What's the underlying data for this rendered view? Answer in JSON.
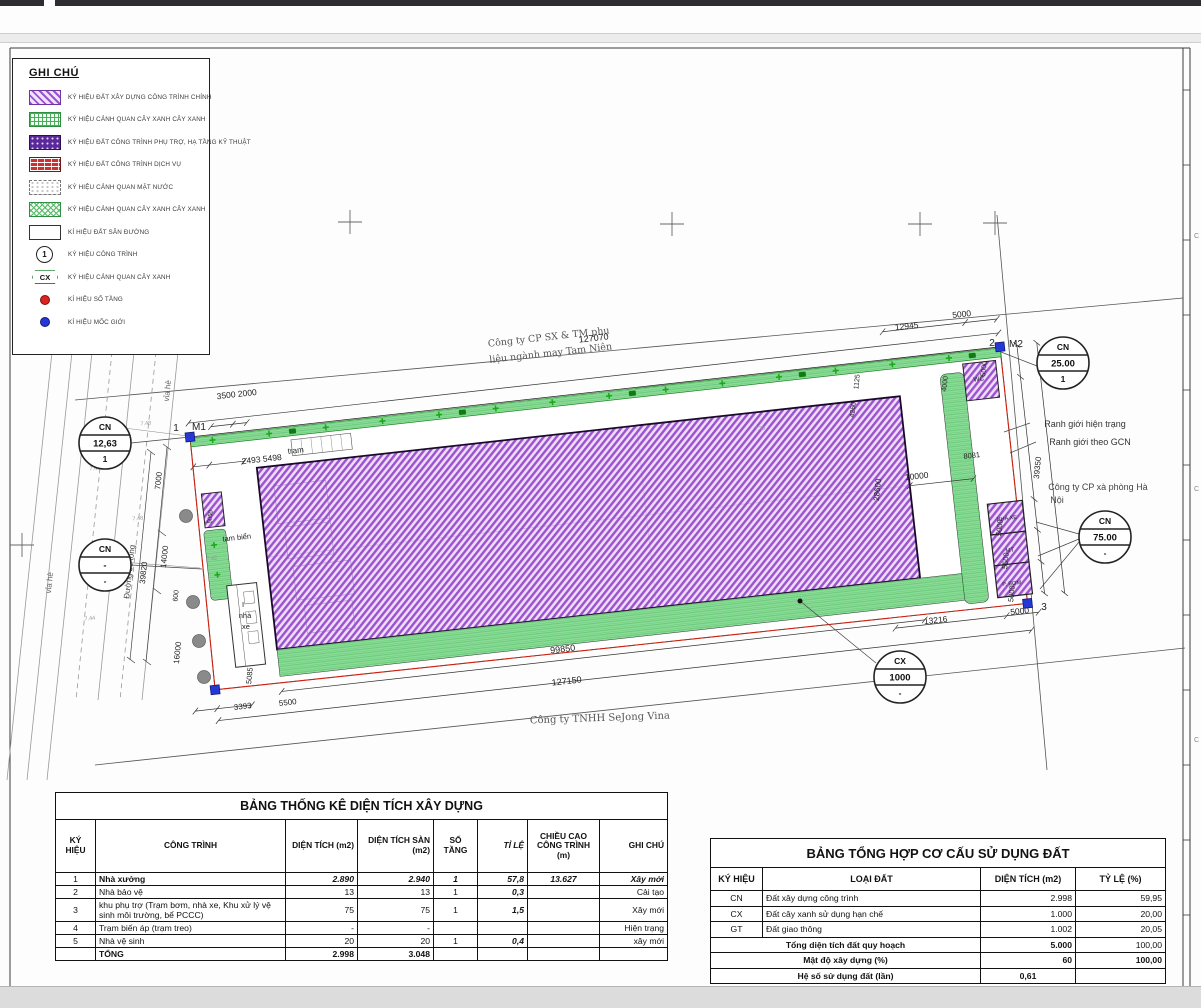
{
  "colors": {
    "purple": "#9b52cf",
    "green": "#79d489",
    "red": "#cc2211",
    "blue": "#2538d6",
    "line": "#333333"
  },
  "legend": {
    "title": "GHI CHÚ",
    "items": [
      {
        "swatch": "hatch-purple",
        "label": "KÝ HIỆU ĐẤT XÂY DỰNG CÔNG TRÌNH CHÍNH"
      },
      {
        "swatch": "grid-green",
        "label": "KÝ HIỆU CẢNH QUAN CÂY XANH CÂY XANH"
      },
      {
        "swatch": "dots-purple",
        "label": "KÝ HIỆU ĐẤT CÔNG TRÌNH PHỤ TRỢ, HẠ TẦNG KỸ THUẬT"
      },
      {
        "swatch": "brick-red",
        "label": "KÝ HIỆU ĐẤT CÔNG TRÌNH DỊCH VỤ"
      },
      {
        "swatch": "dots-white",
        "label": "KÝ HIỆU CẢNH QUAN MẶT NƯỚC"
      },
      {
        "swatch": "cross-green",
        "label": "KÝ HIỆU CẢNH QUAN CÂY XANH CÂY XANH"
      },
      {
        "swatch": "plain-white",
        "label": "KÍ HIỆU ĐẤT SÂN ĐƯỜNG"
      },
      {
        "swatch": "circle-1",
        "symbol": "1",
        "label": "KÝ HIỆU CÔNG TRÌNH"
      },
      {
        "swatch": "cx-badge",
        "symbol": "CX",
        "label": "KÝ HIỆU CẢNH QUAN CÂY XANH"
      },
      {
        "swatch": "dot-red",
        "label": "KÍ HIỆU SỐ TẦNG"
      },
      {
        "swatch": "dot-blue",
        "label": "KÍ HIỆU MỐC GIỚI"
      }
    ]
  },
  "plan": {
    "badges": [
      {
        "x": 105,
        "y": 443,
        "top": "CN",
        "mid": "12,63",
        "bot": "1"
      },
      {
        "x": 105,
        "y": 565,
        "top": "CN",
        "mid": "-",
        "bot": "-"
      },
      {
        "x": 1063,
        "y": 363,
        "top": "CN",
        "mid": "25.00",
        "bot": "1"
      },
      {
        "x": 1105,
        "y": 537,
        "top": "CN",
        "mid": "75.00",
        "bot": "-"
      },
      {
        "x": 900,
        "y": 677,
        "top": "CX",
        "mid": "1000",
        "bot": "-"
      }
    ],
    "texts": [
      {
        "t": "Công ty CP SX & TM phụ",
        "x": 549,
        "y": 340,
        "r": -6.3,
        "s": 9.5,
        "c": "#555",
        "f": 1
      },
      {
        "t": "liệu ngành may Tam Niên",
        "x": 551,
        "y": 356,
        "r": -6.3,
        "s": 9.5,
        "c": "#555",
        "f": 1
      },
      {
        "t": "127070",
        "x": 594,
        "y": 341,
        "r": -6.3,
        "s": 9
      },
      {
        "t": "12945",
        "x": 907,
        "y": 329,
        "r": -6.3,
        "s": 8.5
      },
      {
        "t": "5000",
        "x": 962,
        "y": 317,
        "r": -6.3,
        "s": 8.5
      },
      {
        "t": "1",
        "x": 176,
        "y": 431,
        "r": 0,
        "s": 10
      },
      {
        "t": "M1",
        "x": 199,
        "y": 430,
        "r": 0,
        "s": 10
      },
      {
        "t": "2",
        "x": 992,
        "y": 346,
        "r": 0,
        "s": 10
      },
      {
        "t": "M2",
        "x": 1016,
        "y": 347,
        "r": 0,
        "s": 10
      },
      {
        "t": "3",
        "x": 1044,
        "y": 610,
        "r": 0,
        "s": 10
      },
      {
        "t": "3500 2000",
        "x": 237,
        "y": 397,
        "r": -6.3,
        "s": 8.5
      },
      {
        "t": "2493   5498",
        "x": 262,
        "y": 462,
        "r": -6.3,
        "s": 8.5
      },
      {
        "t": "trạm",
        "x": 296,
        "y": 453,
        "r": -6.3,
        "s": 8
      },
      {
        "t": "tam biển",
        "x": 237,
        "y": 540,
        "r": -6.3,
        "s": 7.5
      },
      {
        "t": "1125",
        "x": 859,
        "y": 382,
        "r": -84,
        "s": 7
      },
      {
        "t": "4260",
        "x": 855,
        "y": 410,
        "r": -84,
        "s": 7
      },
      {
        "t": "4000",
        "x": 947,
        "y": 384,
        "r": -84,
        "s": 7
      },
      {
        "t": "5000",
        "x": 986,
        "y": 369,
        "r": -84,
        "s": 7
      },
      {
        "t": "8081",
        "x": 972,
        "y": 458,
        "r": -6.3,
        "s": 7.5
      },
      {
        "t": "10000",
        "x": 917,
        "y": 479,
        "r": -6.3,
        "s": 8.5
      },
      {
        "t": "28600",
        "x": 880,
        "y": 490,
        "r": -84,
        "s": 8
      },
      {
        "t": "39350",
        "x": 1040,
        "y": 468,
        "r": -84,
        "s": 8
      },
      {
        "t": "Ranh giới hiện trạng",
        "x": 1085,
        "y": 427,
        "r": 0,
        "s": 9,
        "c": "#333"
      },
      {
        "t": "Ranh giới theo GCN",
        "x": 1090,
        "y": 445,
        "r": 0,
        "s": 9,
        "c": "#333"
      },
      {
        "t": "Công ty CP xà phòng Hà",
        "x": 1098,
        "y": 490,
        "r": 0,
        "s": 9,
        "c": "#444"
      },
      {
        "t": "Nội",
        "x": 1057,
        "y": 503,
        "r": 0,
        "s": 9,
        "c": "#444"
      },
      {
        "t": "5000",
        "x": 1002,
        "y": 528,
        "r": -84,
        "s": 7.5
      },
      {
        "t": "5500",
        "x": 1008,
        "y": 561,
        "r": -84,
        "s": 7.5
      },
      {
        "t": "5000",
        "x": 1014,
        "y": 594,
        "r": -84,
        "s": 7.5
      },
      {
        "t": "13216",
        "x": 936,
        "y": 623,
        "r": -6.3,
        "s": 8.5
      },
      {
        "t": "5000",
        "x": 1020,
        "y": 614,
        "r": -6.3,
        "s": 8.5
      },
      {
        "t": "99850",
        "x": 563,
        "y": 652,
        "r": -6.3,
        "s": 9
      },
      {
        "t": "127150",
        "x": 567,
        "y": 684,
        "r": -6.3,
        "s": 9
      },
      {
        "t": "Công ty TNHH SeJong Vina",
        "x": 600,
        "y": 721,
        "r": -2,
        "s": 10,
        "c": "#555",
        "f": 1
      },
      {
        "t": "3393",
        "x": 243,
        "y": 709,
        "r": -6.3,
        "s": 8
      },
      {
        "t": "5500",
        "x": 288,
        "y": 705,
        "r": -6.3,
        "s": 8
      },
      {
        "t": "5085",
        "x": 252,
        "y": 676,
        "r": -84,
        "s": 7.5
      },
      {
        "t": "7000",
        "x": 161,
        "y": 481,
        "r": -84,
        "s": 8
      },
      {
        "t": "14000",
        "x": 167,
        "y": 557,
        "r": -84,
        "s": 8
      },
      {
        "t": "39820",
        "x": 146,
        "y": 573,
        "r": -84,
        "s": 8
      },
      {
        "t": "600",
        "x": 178,
        "y": 596,
        "r": -84,
        "s": 7
      },
      {
        "t": "16000",
        "x": 180,
        "y": 653,
        "r": -84,
        "s": 8
      },
      {
        "t": "vỉa hè",
        "x": 170,
        "y": 391,
        "r": -84,
        "s": 8,
        "c": "#666"
      },
      {
        "t": "vỉa hè",
        "x": 52,
        "y": 583,
        "r": -84,
        "s": 8,
        "c": "#666"
      },
      {
        "t": "Đường bê tông",
        "x": 132,
        "y": 572,
        "r": -84,
        "s": 8,
        "c": "#444"
      },
      {
        "t": "WC",
        "x": 979,
        "y": 381,
        "r": -6.3,
        "s": 6.5
      },
      {
        "t": "NHÀ XE",
        "x": 1007,
        "y": 520,
        "r": -6.3,
        "s": 5.5
      },
      {
        "t": "MT",
        "x": 1010,
        "y": 552,
        "r": -6.3,
        "s": 6
      },
      {
        "t": "P. BƠM",
        "x": 1012,
        "y": 585,
        "r": -6.3,
        "s": 5.5
      },
      {
        "t": "I",
        "x": 243,
        "y": 607,
        "r": 0,
        "s": 7.5
      },
      {
        "t": "nhà",
        "x": 245,
        "y": 618,
        "r": 0,
        "s": 7.5
      },
      {
        "t": "xe",
        "x": 246,
        "y": 629,
        "r": 0,
        "s": 7.5
      },
      {
        "t": "5050",
        "x": 212,
        "y": 517,
        "r": -84,
        "s": 6
      },
      {
        "t": "7.48",
        "x": 146,
        "y": 425,
        "r": -6,
        "s": 5.5,
        "c": "#999"
      },
      {
        "t": "7.46",
        "x": 95,
        "y": 470,
        "r": -6,
        "s": 5.5,
        "c": "#999"
      },
      {
        "t": "7.48",
        "x": 138,
        "y": 520,
        "r": -6,
        "s": 5.5,
        "c": "#999"
      },
      {
        "t": "7.44",
        "x": 90,
        "y": 620,
        "r": -6,
        "s": 5.5,
        "c": "#999"
      },
      {
        "t": "7.42",
        "x": 212,
        "y": 560,
        "r": -6,
        "s": 5.5,
        "c": "#999"
      },
      {
        "t": "7.35",
        "x": 760,
        "y": 430,
        "r": -6,
        "s": 5.5,
        "c": "#999"
      }
    ],
    "dims": [
      {
        "o": "h",
        "c": -14,
        "a": 0,
        "b": 815,
        "ticks": [
          0,
          815
        ]
      },
      {
        "o": "h",
        "c": -28,
        "a": 700,
        "b": 815,
        "ticks": [
          700,
          783,
          815
        ]
      },
      {
        "o": "h",
        "c": -8,
        "a": 22,
        "b": 58,
        "ticks": [
          22,
          44,
          58
        ]
      },
      {
        "o": "h",
        "c": 30,
        "a": 0,
        "b": 51,
        "ticks": [
          0,
          16,
          51
        ]
      },
      {
        "o": "h",
        "c": 263,
        "a": 63,
        "b": 710,
        "ticks": [
          63,
          710
        ]
      },
      {
        "o": "h",
        "c": 285,
        "a": -3,
        "b": 815,
        "ticks": [
          -3,
          815
        ]
      },
      {
        "o": "h",
        "c": 273,
        "a": -25,
        "b": 32,
        "ticks": [
          -25,
          -3,
          32
        ]
      },
      {
        "o": "h",
        "c": 268,
        "a": 680,
        "b": 824,
        "ticks": [
          680,
          792,
          824
        ]
      },
      {
        "o": "h",
        "c": 128,
        "a": 710,
        "b": 774,
        "ticks": [
          710,
          774
        ]
      },
      {
        "o": "v",
        "c": 832,
        "a": 0,
        "b": 250,
        "ticks": [
          0,
          32,
          155,
          186,
          218,
          250
        ]
      },
      {
        "o": "v",
        "c": 852,
        "a": 0,
        "b": 252,
        "ticks": [
          0,
          252
        ]
      }
    ],
    "markers": [
      [
        0,
        0
      ],
      [
        815,
        0
      ],
      [
        -3,
        254
      ],
      [
        814,
        258
      ]
    ],
    "dots": [
      [
        186,
        516
      ],
      [
        193,
        602
      ],
      [
        199,
        641
      ],
      [
        204,
        677
      ]
    ]
  },
  "stat_table": {
    "title": "BẢNG THỐNG KÊ DIỆN TÍCH XÂY DỰNG",
    "headers": [
      "KÝ HIỆU",
      "CÔNG TRÌNH",
      "DIỆN TÍCH (m2)",
      "DIỆN TÍCH SÀN (m2)",
      "SỐ TẦNG",
      "TỈ LỆ",
      "CHIỀU CAO CÔNG TRÌNH (m)",
      "GHI CHÚ"
    ],
    "rows": [
      {
        "cells": [
          "1",
          "Nhà xưởng",
          "2.890",
          "2.940",
          "1",
          "57,8",
          "13.627",
          "Xây mới"
        ],
        "type": "em"
      },
      {
        "cells": [
          "2",
          "Nhà bảo vệ",
          "13",
          "13",
          "1",
          "0,3",
          "",
          "Cải tạo"
        ],
        "type": ""
      },
      {
        "cells": [
          "3",
          "khu phụ trợ (Trạm bơm, nhà xe, Khu xử lý vệ sinh môi trường, bể PCCC)",
          "75",
          "75",
          "1",
          "1,5",
          "",
          "Xây mới"
        ],
        "type": "tall"
      },
      {
        "cells": [
          "4",
          "Trạm biến áp (trạm treo)",
          "-",
          "-",
          "",
          "",
          "",
          "Hiện trạng"
        ],
        "type": ""
      },
      {
        "cells": [
          "5",
          "Nhà vệ sinh",
          "20",
          "20",
          "1",
          "0,4",
          "",
          "xây mới"
        ],
        "type": ""
      },
      {
        "cells": [
          "",
          "TỔNG",
          "2.998",
          "3.048",
          "",
          "",
          "",
          ""
        ],
        "type": "tot"
      }
    ]
  },
  "land_table": {
    "title": "BẢNG TỔNG HỢP CƠ CẤU SỬ DỤNG ĐẤT",
    "headers": [
      "KÝ HIỆU",
      "LOẠI ĐẤT",
      "DIỆN TÍCH (m2)",
      "TỶ LỆ (%)"
    ],
    "rows": [
      {
        "cells": [
          "CN",
          "Đất xây dựng công trình",
          "2.998",
          "59,95"
        ],
        "span": false,
        "bold": false
      },
      {
        "cells": [
          "CX",
          "Đất cây xanh sử dụng hạn chế",
          "1.000",
          "20,00"
        ],
        "span": false,
        "bold": false
      },
      {
        "cells": [
          "GT",
          "Đất giao thông",
          "1.002",
          "20,05"
        ],
        "span": false,
        "bold": false
      },
      {
        "cells": [
          "Tổng diện tích đất quy hoạch",
          "5.000",
          "100,00"
        ],
        "span": true,
        "bold": true,
        "ratioNormal": true
      },
      {
        "cells": [
          "Mật độ xây dựng (%)",
          "60",
          "100,00"
        ],
        "span": true,
        "bold": true,
        "ratioNormal": false
      },
      {
        "cells": [
          "Hệ số sử dụng đất (lần)",
          "0,61",
          ""
        ],
        "span": true,
        "bold": true,
        "ratioNormal": false,
        "center": true
      }
    ]
  }
}
